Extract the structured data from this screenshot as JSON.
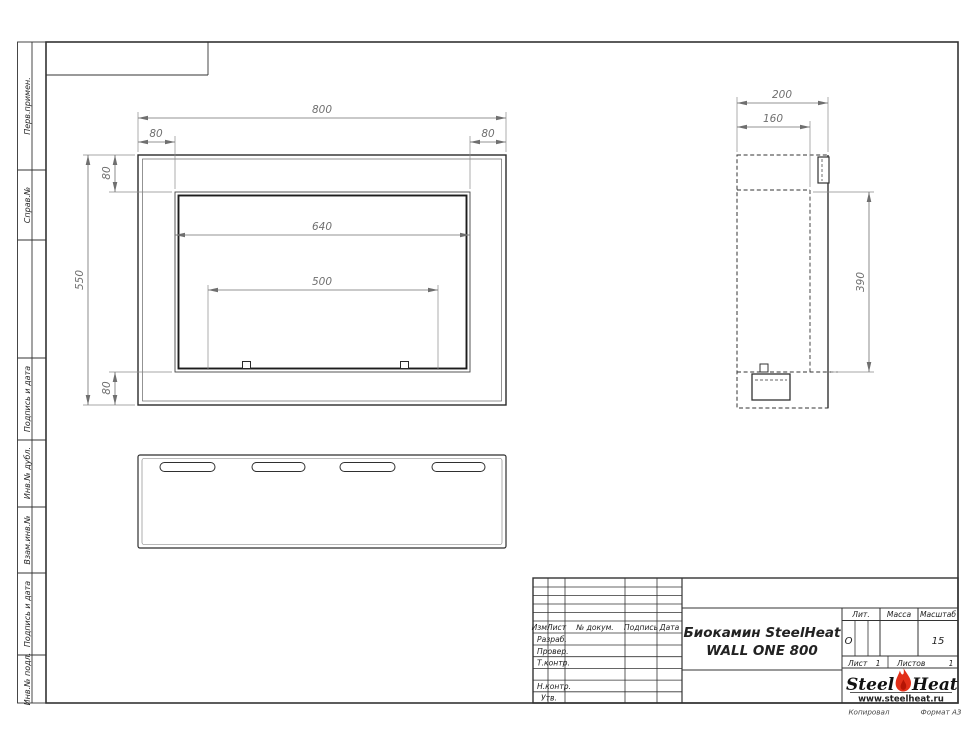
{
  "sidebar": {
    "items": [
      {
        "label": "Перв.примен."
      },
      {
        "label": "Справ.№"
      },
      {
        "label": "Подпись и дата"
      },
      {
        "label": "Инв.№ дубл."
      },
      {
        "label": "Взам.инв.№"
      },
      {
        "label": "Подпись и дата"
      },
      {
        "label": "Инв.№ подл."
      }
    ]
  },
  "views": {
    "front": {
      "dims": {
        "total_width": "800",
        "left_margin": "80",
        "right_margin": "80",
        "top_margin": "80",
        "opening_width": "640",
        "burner_span": "500",
        "total_height": "550",
        "bottom_margin": "80"
      }
    },
    "side": {
      "dims": {
        "total_depth": "200",
        "inner_depth": "160",
        "opening_height": "390"
      }
    }
  },
  "title_block": {
    "revision_header": {
      "izm": "Изм.",
      "list": "Лист",
      "doc": "№ докум.",
      "podpis": "Подпись",
      "data": "Дата"
    },
    "signature_rows": [
      {
        "label": "Разраб."
      },
      {
        "label": "Провер."
      },
      {
        "label": "Т.контр."
      },
      {
        "label": "Н.контр."
      },
      {
        "label": "Утв."
      }
    ],
    "title_line1": "Биокамин SteelHeat",
    "title_line2": "WALL ONE 800",
    "lit_label": "Лит.",
    "lit_value": "О",
    "mass_label": "Масса",
    "scale_label": "Масштаб",
    "scale_value": "15",
    "sheet_label": "Лист",
    "sheet_value": "1",
    "sheets_label": "Листов",
    "sheets_value": "1",
    "logo": {
      "word1": "Steel",
      "word2": "Heat",
      "website": "www.steelheat.ru"
    },
    "footer_left": "Копировал",
    "footer_right": "Формат А3"
  },
  "colors": {
    "object_line": "#2b2b2b",
    "thin_line": "#555555",
    "dim_line": "#6f6f6f",
    "flame_red": "#e22f18",
    "flame_core": "#b51505"
  }
}
